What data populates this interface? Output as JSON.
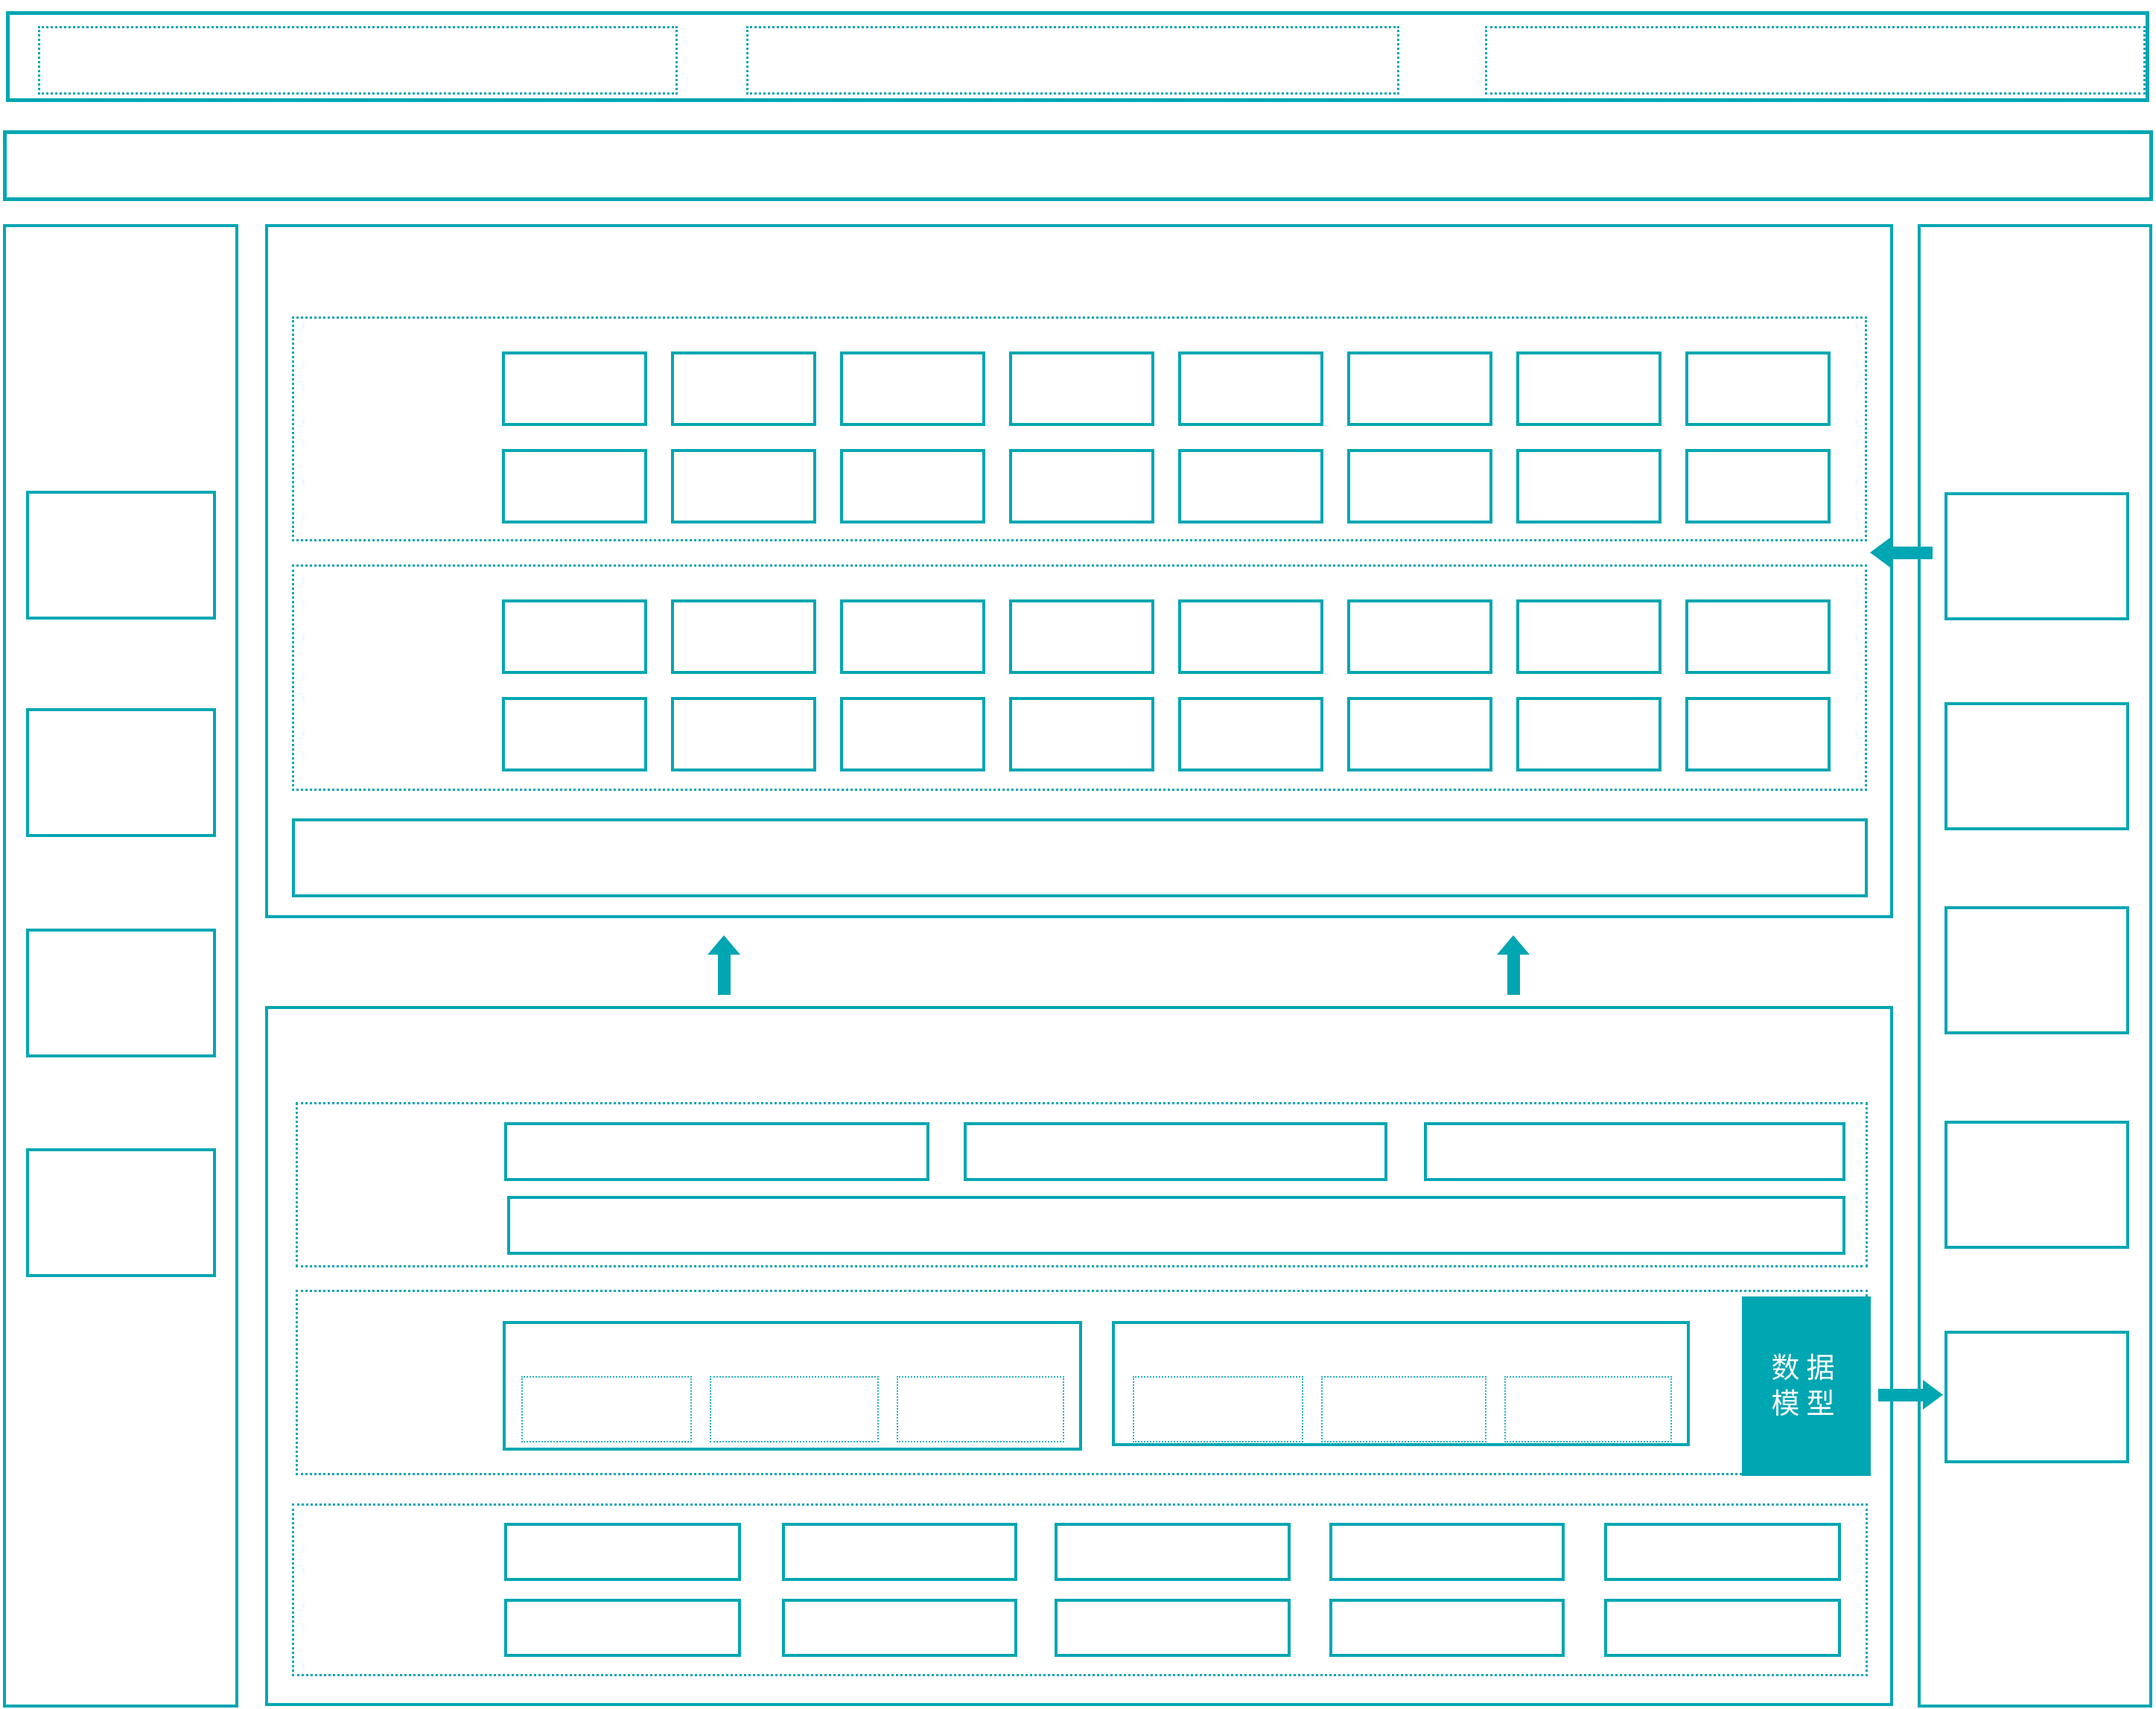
{
  "diagram": {
    "type": "architecture-wireframe",
    "accent_color": "#00a6b2",
    "background_color": "#ffffff",
    "labels": {
      "data_model": "数据模型"
    },
    "icons": [
      "up-arrow",
      "up-arrow",
      "left-arrow",
      "right-arrow"
    ],
    "layout_summary": {
      "top_bar_slots": 3,
      "left_panel_boxes": 4,
      "right_panel_boxes": 5,
      "top_panel_grid_sections": 2,
      "grid_rows": 2,
      "grid_cols": 8,
      "bottom_row_boxes": 3,
      "group_boxes": 2,
      "group_sub_slots": 3,
      "bottom_grid_rows": 2,
      "bottom_grid_cols": 5
    }
  }
}
